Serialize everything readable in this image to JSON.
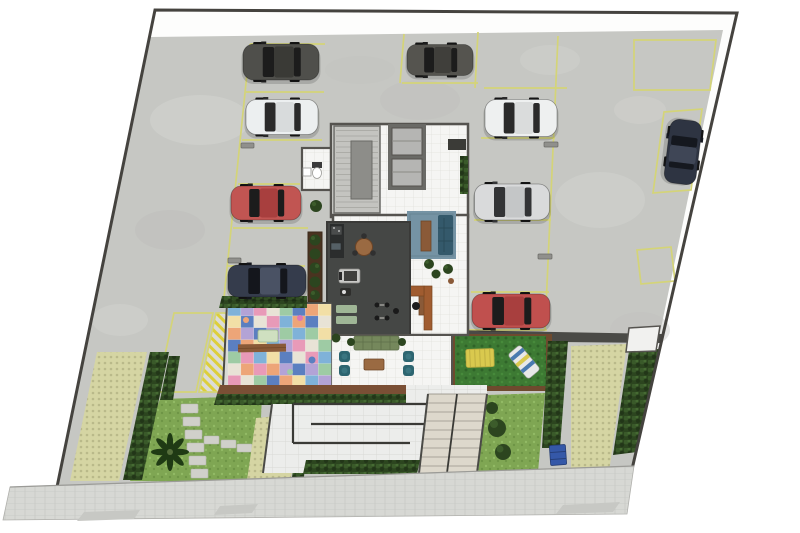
{
  "canvas": {
    "w": 800,
    "h": 533,
    "bg": "#ffffff"
  },
  "site": {
    "boundary_color": "#45433f",
    "concrete_color": "#c6c7c3",
    "sidewalk_color": "#d7d8d4",
    "apron_color": "#c7c8c4"
  },
  "parking": {
    "line_color": "#d4d478",
    "wheel_stop_color": "#90908c",
    "cars_visible": 9
  },
  "building": {
    "wall_color": "#55534f",
    "tile_floor_color": "#f5f5f3",
    "gym_floor_color": "#454745",
    "stair_color": "#c4c4c0",
    "stair_landing_color": "#8d8d89",
    "elevator_shaft_color": "#6a6a66",
    "elevator_cabin_color": "#b5b5b3",
    "rug_color": "#7593a4",
    "sofa_color": "#34596b",
    "bench_wood_color": "#8a5a38",
    "desk_color": "#a05c30",
    "gym_mat_color": "#9fb696",
    "green_sofa_color": "#75885c",
    "pouf_color": "#2d6570",
    "coffee_table_color": "#9a6a42",
    "counter_color": "#2b2d2d"
  },
  "playroom": {
    "cols": 8,
    "rows": 7,
    "palette": [
      "#7fb2d9",
      "#5b7fc0",
      "#e89ab8",
      "#f2dfa6",
      "#9ecba4",
      "#b3a3d6",
      "#eda578",
      "#e8e3d6"
    ],
    "deck_color": "#7a4f35"
  },
  "landscape": {
    "lawn_color": "#7fa653",
    "deck_lawn_color": "#3d7a33",
    "deck_rim_color": "#6e4a2e",
    "hedge_color": "#2c451f",
    "grasspaver_base": "#d5d5a3",
    "grasspaver_dot": "#b9b98a",
    "palm_color": "#1f3a14",
    "bench_yellow": "#d9c94e",
    "lounger_stripe_blue": "#4a7ab0",
    "lounger_stripe_yellow": "#d9c94e",
    "dumpster_color": "#3558a8",
    "hatch_color": "#ddcf3a",
    "gate_color": "#f1f1ef"
  },
  "cars": [
    {
      "name": "car-darkgray-left-top",
      "body": "#4f4f4b",
      "roof": "#3a3a36",
      "glass": "#1c1c1c"
    },
    {
      "name": "car-white-left",
      "body": "#eceff0",
      "roof": "#d8dbdc",
      "glass": "#2a2a2a"
    },
    {
      "name": "car-red-left",
      "body": "#c15552",
      "roof": "#a83f3e",
      "glass": "#1c1c1c"
    },
    {
      "name": "car-navy-left",
      "body": "#353c4c",
      "roof": "#4a5264",
      "glass": "#14161c"
    },
    {
      "name": "car-darkgray-top-mid",
      "body": "#55544f",
      "roof": "#403f3b",
      "glass": "#1c1c1c"
    },
    {
      "name": "car-white-right",
      "body": "#eef0f0",
      "roof": "#dadcdc",
      "glass": "#2a2a2a"
    },
    {
      "name": "car-silver-right",
      "body": "#d9dadb",
      "roof": "#c4c6c7",
      "glass": "#333436"
    },
    {
      "name": "car-red-right",
      "body": "#c0504e",
      "roof": "#a83f3e",
      "glass": "#1c1c1c"
    },
    {
      "name": "car-navy-right-edge",
      "body": "#2e3442",
      "roof": "#3f4656",
      "glass": "#15181f"
    }
  ]
}
